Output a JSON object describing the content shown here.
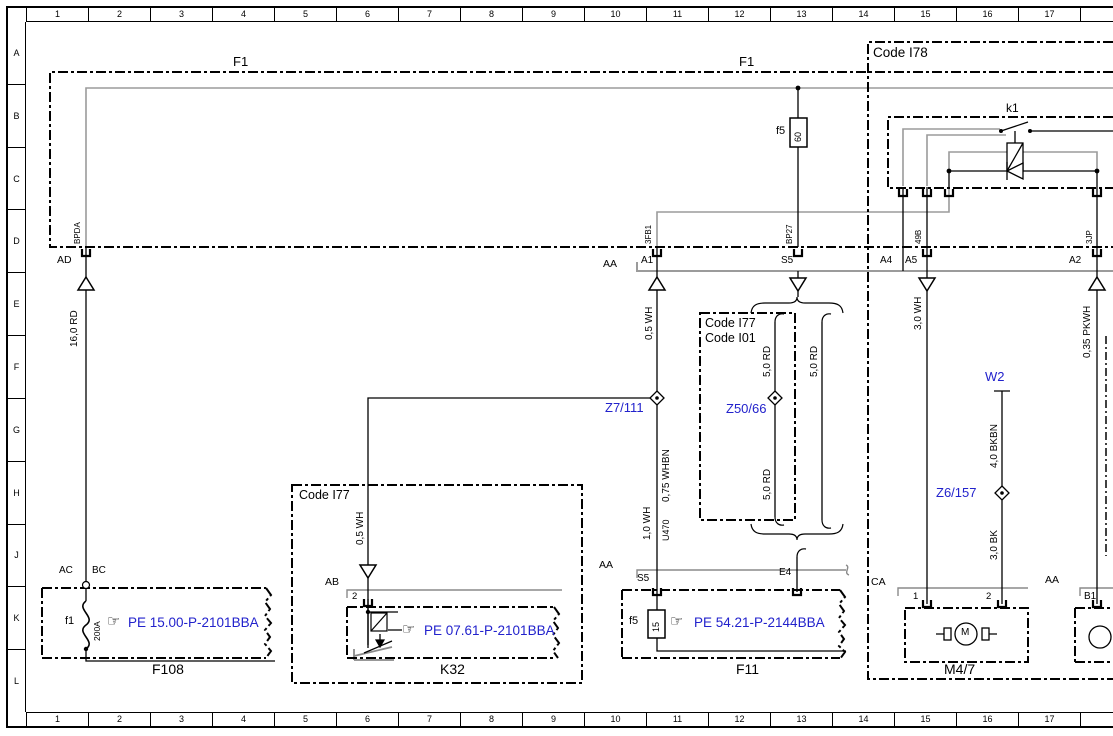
{
  "colors": {
    "link": "#2222cc",
    "line": "#000000",
    "harness_gray": "#9b9b9b"
  },
  "rulers": {
    "columns": [
      "1",
      "2",
      "3",
      "4",
      "5",
      "6",
      "7",
      "8",
      "9",
      "10",
      "11",
      "12",
      "13",
      "14",
      "15",
      "16",
      "17"
    ],
    "rows": [
      "A",
      "B",
      "C",
      "D",
      "E",
      "F",
      "G",
      "H",
      "J",
      "K",
      "L"
    ]
  },
  "f1": {
    "label_left": "F1",
    "label_right": "F1",
    "fuse": {
      "name": "f5",
      "rating": "60"
    },
    "sleeves": {
      "bpda": "BPDA",
      "fb1": "3FB1",
      "bp27": "BP27",
      "b49": "49B",
      "jp3": "3JP"
    }
  },
  "i78": {
    "label": "Code I78",
    "k1": "k1",
    "a4": "A4",
    "a5": "A5",
    "a2": "A2",
    "m47": {
      "conn": "CA",
      "pin1": "1",
      "pin2": "2",
      "motor": "M",
      "label": "M4/7"
    },
    "right": {
      "conn": "AA",
      "pin": "B1"
    }
  },
  "aa": {
    "label": "AA",
    "a1": "A1",
    "s5": "S5"
  },
  "ad": "AD",
  "wires": {
    "rd16": "16,0 RD",
    "wh05_a": "0,5 WH",
    "wh05_b": "0,5 WH",
    "rd50_a": "5,0 RD",
    "rd50_b": "5,0 RD",
    "rd50_c": "5,0 RD",
    "wh30": "3,0 WH",
    "pkwh035": "0,35 PKWH",
    "bkbn40": "4,0 BKBN",
    "bk30": "3,0 BK",
    "wh10": "1,0 WH",
    "whbn075": "0,75 WHBN",
    "u470": "U470"
  },
  "refs": {
    "z7_111": "Z7/111",
    "z50_66": "Z50/66",
    "z6_157": "Z6/157",
    "w2": "W2"
  },
  "i77i01": {
    "line1": "Code I77",
    "line2": "Code I01"
  },
  "f108": {
    "ac": "AC",
    "bc": "BC",
    "fuse": "f1",
    "rating": "200A",
    "hand": "☞",
    "pe": "PE 15.00-P-2101BBA",
    "label": "F108"
  },
  "k32": {
    "code": "Code I77",
    "ab": "AB",
    "pin": "2",
    "hand": "☞",
    "pe": "PE 07.61-P-2101BBA",
    "label": "K32"
  },
  "f11": {
    "conn": "AA",
    "s5": "S5",
    "e4": "E4",
    "fuse": "f5",
    "rating": "15",
    "hand": "☞",
    "pe": "PE 54.21-P-2144BBA",
    "label": "F11"
  }
}
